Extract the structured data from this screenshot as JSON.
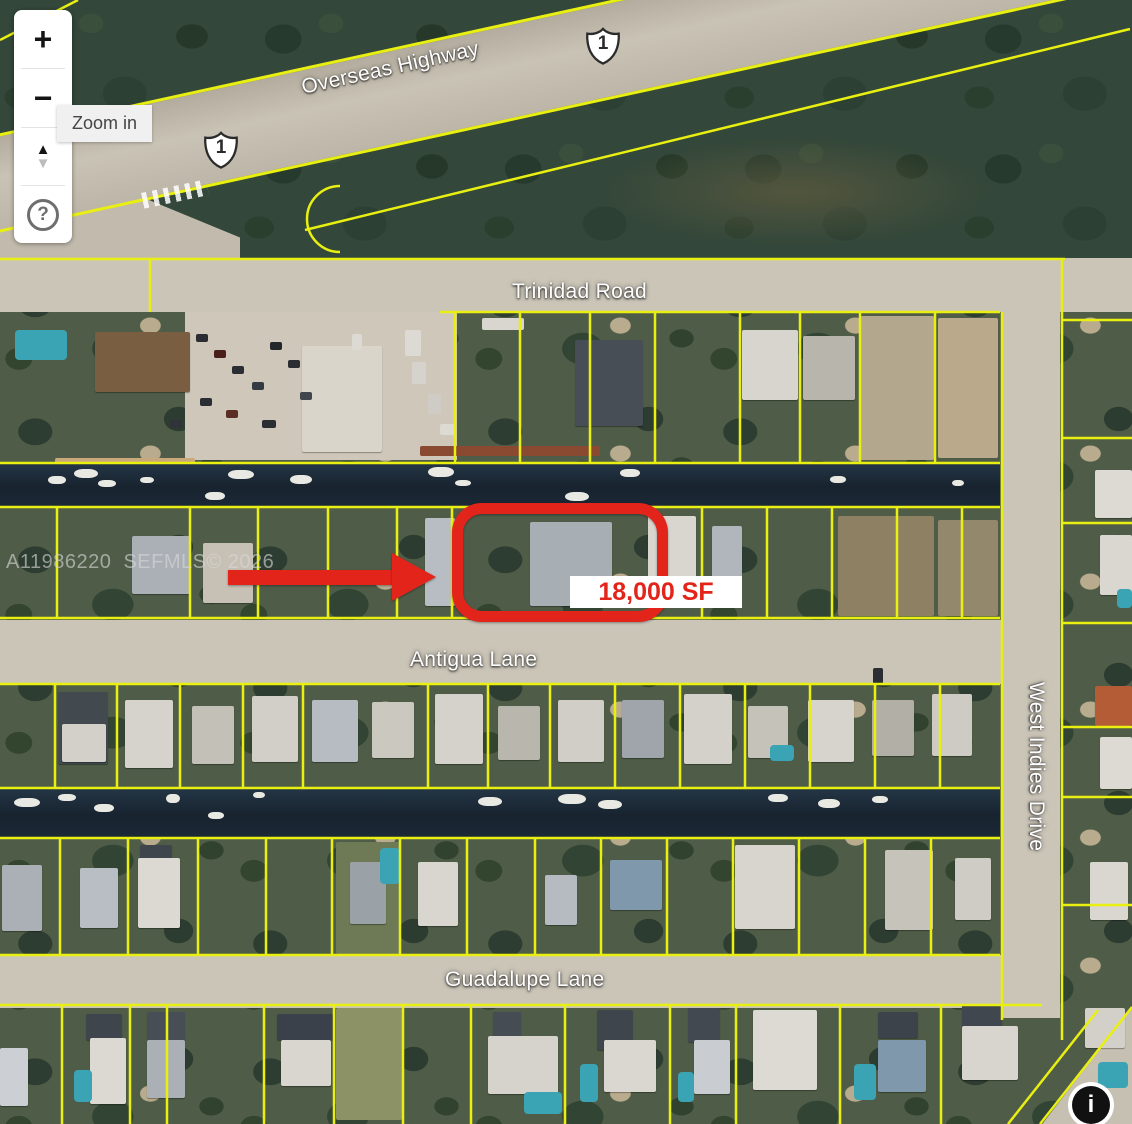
{
  "controls": {
    "zoom_in_glyph": "+",
    "zoom_out_glyph": "−",
    "tilt_up_glyph": "▲",
    "tilt_down_glyph": "▼",
    "help_glyph": "?",
    "tooltip": "Zoom in",
    "info_glyph": "i"
  },
  "labels": {
    "overseas_highway": "Overseas Highway",
    "route_1": "1",
    "trinidad_road": "Trinidad Road",
    "antigua_lane": "Antigua Lane",
    "west_indies_drive": "West Indies Drive",
    "guadalupe_lane": "Guadalupe Lane"
  },
  "annotations": {
    "area_label": "18,000 SF",
    "watermark": "A11986220  SEFMLS© 2026"
  },
  "colors": {
    "parcel_line": "#e9f011",
    "highlight_red": "#e3241b",
    "water": "#1b2836",
    "road": "#cbc5b8",
    "pool": "#3ba4b4",
    "boat": "#e9e9e3",
    "area_label_bg": "#ffffff"
  },
  "map_features": {
    "patches": [
      [
        185,
        313,
        272,
        146,
        "#cfc8ba"
      ],
      [
        860,
        316,
        74,
        144,
        "#b3a78d"
      ],
      [
        938,
        318,
        60,
        140,
        "#baa98a"
      ],
      [
        838,
        516,
        96,
        100,
        "#8d8063"
      ],
      [
        938,
        520,
        60,
        96,
        "#94886c"
      ],
      [
        336,
        842,
        64,
        112,
        "#6d7a55"
      ],
      [
        336,
        1008,
        66,
        112,
        "#8d9166"
      ],
      [
        420,
        446,
        180,
        10,
        "#8a4a32"
      ],
      [
        55,
        458,
        140,
        6,
        "#c9a87c"
      ]
    ],
    "houses": [
      [
        95,
        332,
        95,
        60,
        "#7a5e42"
      ],
      [
        302,
        346,
        80,
        106,
        "#d9d5cb"
      ],
      [
        575,
        340,
        68,
        86,
        "#474e56"
      ],
      [
        742,
        330,
        56,
        70,
        "#d7d5ce"
      ],
      [
        803,
        336,
        52,
        64,
        "#b8b5ad"
      ],
      [
        132,
        536,
        58,
        58,
        "#aab0b6"
      ],
      [
        203,
        543,
        50,
        60,
        "#c7c1b5"
      ],
      [
        425,
        518,
        30,
        88,
        "#b7bdc3"
      ],
      [
        530,
        522,
        82,
        84,
        "#a7aeb4"
      ],
      [
        648,
        516,
        48,
        86,
        "#d8d6cf"
      ],
      [
        712,
        526,
        30,
        54,
        "#b0b6bc"
      ],
      [
        1095,
        470,
        37,
        48,
        "#dcdad3"
      ],
      [
        1100,
        535,
        32,
        60,
        "#d9d7d0"
      ],
      [
        58,
        692,
        50,
        72,
        "#42494f"
      ],
      [
        62,
        724,
        44,
        38,
        "#d2d0c9"
      ],
      [
        125,
        700,
        48,
        68,
        "#d5d3cc"
      ],
      [
        192,
        706,
        42,
        58,
        "#c3c0b8"
      ],
      [
        252,
        696,
        46,
        66,
        "#d1cfc8"
      ],
      [
        312,
        700,
        46,
        62,
        "#b6bcc2"
      ],
      [
        372,
        702,
        42,
        56,
        "#cbc8c0"
      ],
      [
        435,
        694,
        48,
        70,
        "#d4d2cb"
      ],
      [
        498,
        706,
        42,
        54,
        "#b9b6ae"
      ],
      [
        558,
        700,
        46,
        62,
        "#d0cec7"
      ],
      [
        622,
        700,
        42,
        58,
        "#9fa5ab"
      ],
      [
        684,
        694,
        48,
        70,
        "#d3d1ca"
      ],
      [
        748,
        706,
        40,
        52,
        "#c5c2ba"
      ],
      [
        808,
        700,
        46,
        62,
        "#d6d4cd"
      ],
      [
        872,
        700,
        42,
        56,
        "#b2afa7"
      ],
      [
        932,
        694,
        40,
        62,
        "#cecbc4"
      ],
      [
        1095,
        686,
        37,
        40,
        "#b35c35"
      ],
      [
        1100,
        737,
        32,
        52,
        "#dcdad3"
      ],
      [
        2,
        865,
        40,
        66,
        "#aab0b6"
      ],
      [
        80,
        868,
        38,
        60,
        "#b8bec4"
      ],
      [
        140,
        845,
        32,
        16,
        "#3e454d"
      ],
      [
        138,
        858,
        42,
        70,
        "#dbd9d2"
      ],
      [
        350,
        862,
        36,
        62,
        "#9aa1a7"
      ],
      [
        418,
        862,
        40,
        64,
        "#d8d6cf"
      ],
      [
        545,
        875,
        32,
        50,
        "#b5bbc1"
      ],
      [
        610,
        860,
        52,
        50,
        "#7f98ac"
      ],
      [
        735,
        845,
        60,
        84,
        "#d7d5ce"
      ],
      [
        885,
        850,
        48,
        80,
        "#c6c3bb"
      ],
      [
        955,
        858,
        36,
        62,
        "#cfccc5"
      ],
      [
        1090,
        862,
        38,
        58,
        "#d9d7d0"
      ],
      [
        0,
        1048,
        28,
        58,
        "#ccd0d4"
      ],
      [
        86,
        1014,
        36,
        26,
        "#3e454d"
      ],
      [
        90,
        1038,
        36,
        66,
        "#dbd9d2"
      ],
      [
        147,
        1012,
        38,
        28,
        "#474e56"
      ],
      [
        147,
        1040,
        38,
        58,
        "#aab0b6"
      ],
      [
        277,
        1014,
        56,
        26,
        "#3a414b"
      ],
      [
        281,
        1040,
        50,
        46,
        "#d8d6cf"
      ],
      [
        493,
        1012,
        28,
        26,
        "#454c54"
      ],
      [
        488,
        1036,
        70,
        58,
        "#d5d3cc"
      ],
      [
        597,
        1010,
        36,
        40,
        "#3e454d"
      ],
      [
        604,
        1040,
        52,
        52,
        "#d9d7d0"
      ],
      [
        688,
        1008,
        32,
        34,
        "#424950"
      ],
      [
        694,
        1040,
        36,
        54,
        "#c9ccd0"
      ],
      [
        753,
        1010,
        64,
        80,
        "#dcdad3"
      ],
      [
        878,
        1012,
        40,
        26,
        "#3c434b"
      ],
      [
        878,
        1040,
        48,
        52,
        "#7f98ac"
      ],
      [
        962,
        1004,
        40,
        24,
        "#40474f"
      ],
      [
        962,
        1026,
        56,
        54,
        "#d7d5ce"
      ],
      [
        1085,
        1008,
        40,
        40,
        "#d2d0c9"
      ]
    ],
    "pools": [
      [
        15,
        330,
        52,
        30
      ],
      [
        1117,
        589,
        15,
        19
      ],
      [
        770,
        745,
        24,
        16
      ],
      [
        380,
        848,
        20,
        36
      ],
      [
        74,
        1070,
        18,
        32
      ],
      [
        524,
        1092,
        38,
        22
      ],
      [
        580,
        1064,
        18,
        38
      ],
      [
        678,
        1072,
        16,
        30
      ],
      [
        854,
        1064,
        22,
        36
      ],
      [
        1098,
        1062,
        30,
        26
      ]
    ],
    "cars": [
      [
        196,
        334,
        12,
        8,
        "#2a2d31"
      ],
      [
        214,
        350,
        12,
        8,
        "#4a1f1a"
      ],
      [
        232,
        366,
        12,
        8,
        "#2a2d31"
      ],
      [
        252,
        382,
        12,
        8,
        "#333a41"
      ],
      [
        200,
        398,
        12,
        8,
        "#2a2d31"
      ],
      [
        226,
        410,
        12,
        8,
        "#5a2e24"
      ],
      [
        270,
        342,
        12,
        8,
        "#23262a"
      ],
      [
        288,
        360,
        12,
        8,
        "#2a2d31"
      ],
      [
        300,
        392,
        12,
        8,
        "#41464c"
      ],
      [
        262,
        420,
        14,
        8,
        "#2a2d31"
      ],
      [
        170,
        420,
        12,
        8,
        "#30343a"
      ],
      [
        352,
        334,
        10,
        16,
        "#dcdad3"
      ],
      [
        405,
        330,
        16,
        26,
        "#dcdad3"
      ],
      [
        412,
        362,
        14,
        22,
        "#d5d3cc"
      ],
      [
        428,
        394,
        13,
        20,
        "#cfccc5"
      ],
      [
        440,
        424,
        16,
        11,
        "#dcdad3"
      ],
      [
        482,
        318,
        42,
        12,
        "#d8d6cf"
      ],
      [
        873,
        668,
        10,
        16,
        "#2a2d31"
      ]
    ],
    "boats": [
      [
        48,
        476,
        18,
        8
      ],
      [
        74,
        469,
        24,
        9
      ],
      [
        98,
        480,
        18,
        7
      ],
      [
        140,
        477,
        14,
        6
      ],
      [
        228,
        470,
        26,
        9
      ],
      [
        290,
        475,
        22,
        9
      ],
      [
        428,
        467,
        26,
        10
      ],
      [
        455,
        480,
        16,
        6
      ],
      [
        620,
        469,
        20,
        8
      ],
      [
        830,
        476,
        16,
        7
      ],
      [
        952,
        480,
        12,
        6
      ],
      [
        205,
        492,
        20,
        8
      ],
      [
        565,
        492,
        24,
        9
      ],
      [
        14,
        798,
        26,
        9
      ],
      [
        58,
        794,
        18,
        7
      ],
      [
        94,
        804,
        20,
        8
      ],
      [
        166,
        794,
        14,
        9
      ],
      [
        208,
        812,
        16,
        7
      ],
      [
        253,
        792,
        12,
        6
      ],
      [
        478,
        797,
        24,
        9
      ],
      [
        558,
        794,
        28,
        10
      ],
      [
        598,
        800,
        24,
        9
      ],
      [
        768,
        794,
        20,
        8
      ],
      [
        818,
        799,
        22,
        9
      ],
      [
        872,
        796,
        16,
        7
      ]
    ],
    "h_lines": [
      [
        259,
        0,
        1065
      ],
      [
        312,
        440,
        1000
      ],
      [
        463,
        0,
        1000
      ],
      [
        507,
        0,
        1000
      ],
      [
        618,
        0,
        1000
      ],
      [
        684,
        0,
        1000
      ],
      [
        788,
        0,
        1000
      ],
      [
        838,
        0,
        1000
      ],
      [
        955,
        0,
        1000
      ],
      [
        1005,
        0,
        1042
      ],
      [
        320,
        1062,
        1132
      ],
      [
        438,
        1062,
        1132
      ],
      [
        523,
        1062,
        1132
      ],
      [
        623,
        1062,
        1132
      ],
      [
        727,
        1062,
        1132
      ],
      [
        797,
        1062,
        1132
      ],
      [
        905,
        1062,
        1132
      ]
    ],
    "v_lines": [
      [
        150,
        259,
        312
      ],
      [
        455,
        312,
        463
      ],
      [
        520,
        312,
        463
      ],
      [
        590,
        312,
        463
      ],
      [
        655,
        312,
        463
      ],
      [
        740,
        312,
        463
      ],
      [
        800,
        312,
        463
      ],
      [
        860,
        312,
        463
      ],
      [
        935,
        312,
        463
      ],
      [
        57,
        507,
        618
      ],
      [
        190,
        507,
        618
      ],
      [
        258,
        507,
        618
      ],
      [
        328,
        507,
        618
      ],
      [
        397,
        507,
        618
      ],
      [
        452,
        507,
        618
      ],
      [
        702,
        507,
        618
      ],
      [
        767,
        507,
        618
      ],
      [
        832,
        507,
        618
      ],
      [
        897,
        507,
        618
      ],
      [
        962,
        507,
        618
      ],
      [
        55,
        684,
        788
      ],
      [
        117,
        684,
        788
      ],
      [
        180,
        684,
        788
      ],
      [
        243,
        684,
        788
      ],
      [
        303,
        684,
        788
      ],
      [
        428,
        684,
        788
      ],
      [
        488,
        684,
        788
      ],
      [
        550,
        684,
        788
      ],
      [
        615,
        684,
        788
      ],
      [
        680,
        684,
        788
      ],
      [
        745,
        684,
        788
      ],
      [
        810,
        684,
        788
      ],
      [
        875,
        684,
        788
      ],
      [
        940,
        684,
        788
      ],
      [
        60,
        838,
        955
      ],
      [
        128,
        838,
        955
      ],
      [
        198,
        838,
        955
      ],
      [
        266,
        838,
        955
      ],
      [
        332,
        838,
        955
      ],
      [
        400,
        838,
        955
      ],
      [
        467,
        838,
        955
      ],
      [
        535,
        838,
        955
      ],
      [
        601,
        838,
        955
      ],
      [
        667,
        838,
        955
      ],
      [
        733,
        838,
        955
      ],
      [
        799,
        838,
        955
      ],
      [
        865,
        838,
        955
      ],
      [
        931,
        838,
        955
      ],
      [
        62,
        1005,
        1124
      ],
      [
        130,
        1005,
        1124
      ],
      [
        167,
        1005,
        1124
      ],
      [
        264,
        1005,
        1124
      ],
      [
        334,
        1005,
        1124
      ],
      [
        403,
        1005,
        1124
      ],
      [
        471,
        1005,
        1124
      ],
      [
        565,
        1005,
        1124
      ],
      [
        670,
        1005,
        1124
      ],
      [
        736,
        1005,
        1124
      ],
      [
        840,
        1005,
        1124
      ],
      [
        941,
        1005,
        1124
      ],
      [
        1002,
        312,
        1020
      ],
      [
        1062,
        259,
        1040
      ]
    ],
    "d_lines": [
      [
        0,
        40,
        78,
        0
      ],
      [
        305,
        230,
        1130,
        29
      ],
      [
        1040,
        1124,
        1132,
        1007
      ],
      [
        1008,
        1124,
        1098,
        1010
      ]
    ],
    "curves": [
      "M340,186 A33,33 0 0 0 340,252"
    ]
  }
}
